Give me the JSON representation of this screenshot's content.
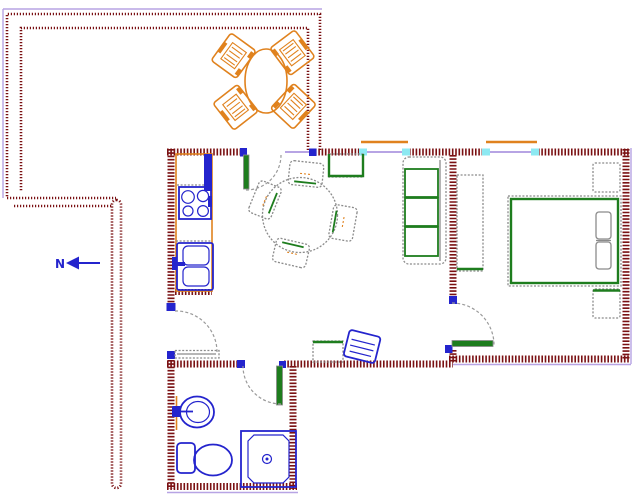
{
  "north_indicator": {
    "label": "N"
  },
  "colors": {
    "wall_maroon": "#7a1113",
    "fixture_blue": "#2424cd",
    "accent_green": "#1e7d1e",
    "counter_orange": "#e0821e",
    "outline_gray": "#8b8b8b",
    "window_cyan": "#8de9f2",
    "glass_lavender": "#b7a4e4",
    "background": "#ffffff"
  },
  "furniture_symbols": [
    "patio-dining-table",
    "patio-chair",
    "refrigerator",
    "stove",
    "kitchen-sink",
    "dining-table",
    "dining-chair",
    "tv-cabinet",
    "sofa",
    "wardrobe",
    "double-bed",
    "pillow",
    "nightstand",
    "side-table",
    "armchair",
    "wash-basin",
    "toilet",
    "shower",
    "north-arrow",
    "door-swing",
    "window"
  ]
}
